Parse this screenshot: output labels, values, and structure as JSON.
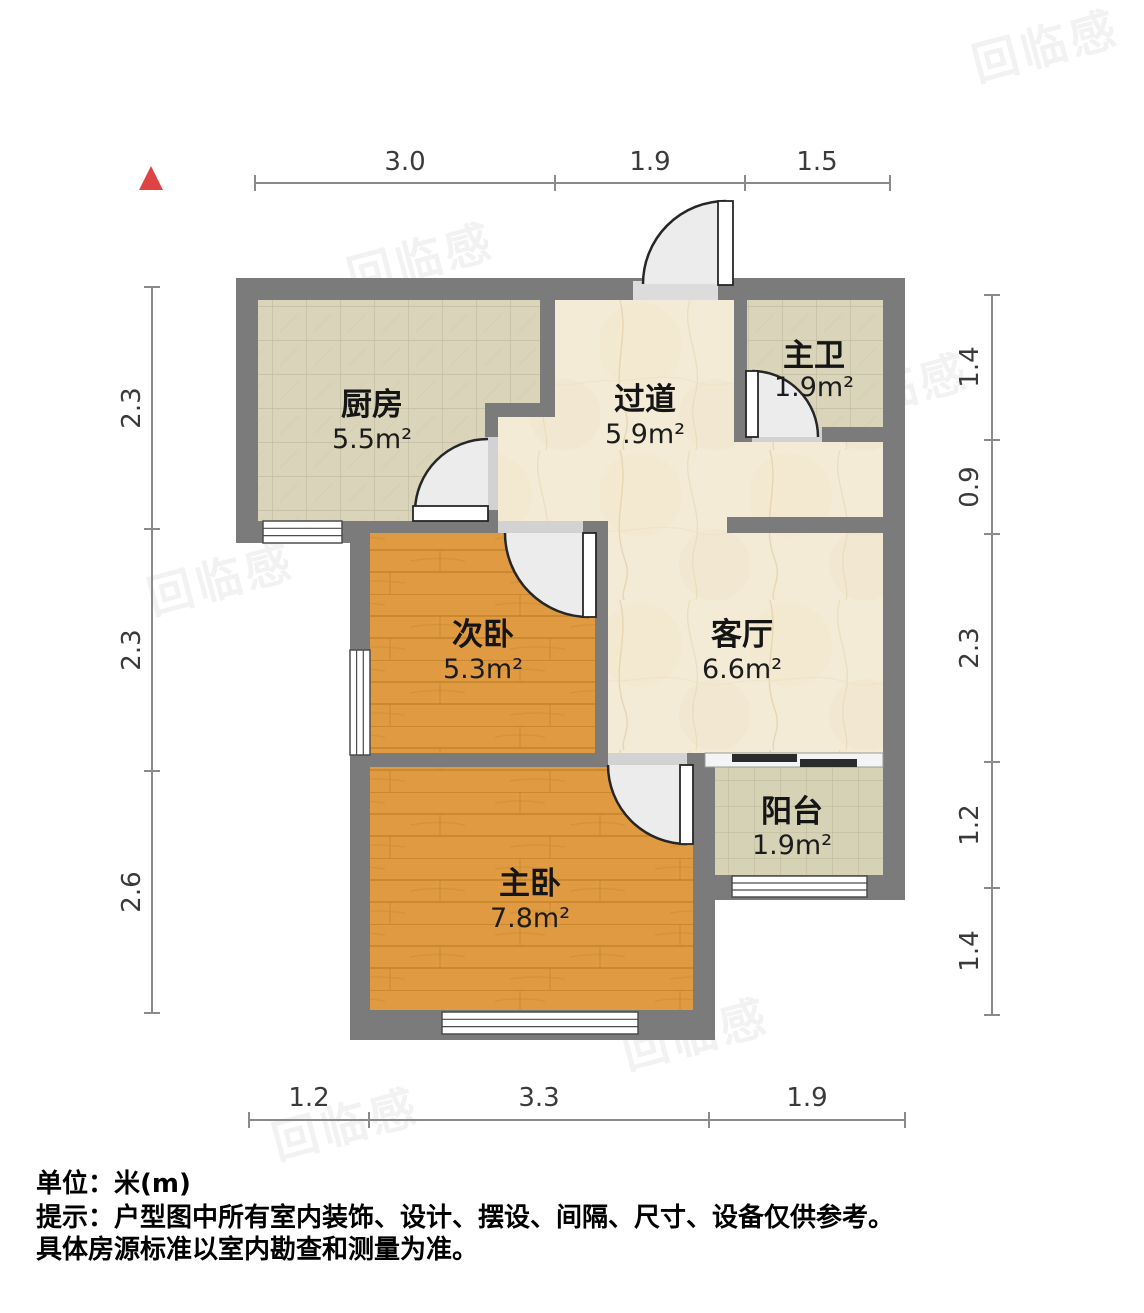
{
  "plan": {
    "rooms": [
      {
        "name": "厨房",
        "area": "5.5m²"
      },
      {
        "name": "过道",
        "area": "5.9m²"
      },
      {
        "name": "主卫",
        "area": "1.9m²"
      },
      {
        "name": "次卧",
        "area": "5.3m²"
      },
      {
        "name": "客厅",
        "area": "6.6m²"
      },
      {
        "name": "阳台",
        "area": "1.9m²"
      },
      {
        "name": "主卧",
        "area": "7.8m²"
      }
    ],
    "dims": {
      "top": [
        "3.0",
        "1.9",
        "1.5"
      ],
      "left": [
        "2.3",
        "2.3",
        "2.6"
      ],
      "right": [
        "1.4",
        "0.9",
        "2.3",
        "1.2",
        "1.4"
      ],
      "bottom": [
        "1.2",
        "3.3",
        "1.9"
      ]
    },
    "colors": {
      "wall": "#7b7b7b",
      "wood_floor": "#e09a41",
      "tile_floor": "#d9d4ba",
      "marble_floor": "#f4ebd6",
      "north_arrow": "#e04343"
    }
  },
  "watermark": {
    "text": "回临感"
  },
  "footer": {
    "unit_line": "单位：米(m)",
    "notice_line1": "提示：户型图中所有室内装饰、设计、摆设、间隔、尺寸、设备仅供参考。",
    "notice_line2": "具体房源标准以室内勘查和测量为准。"
  }
}
